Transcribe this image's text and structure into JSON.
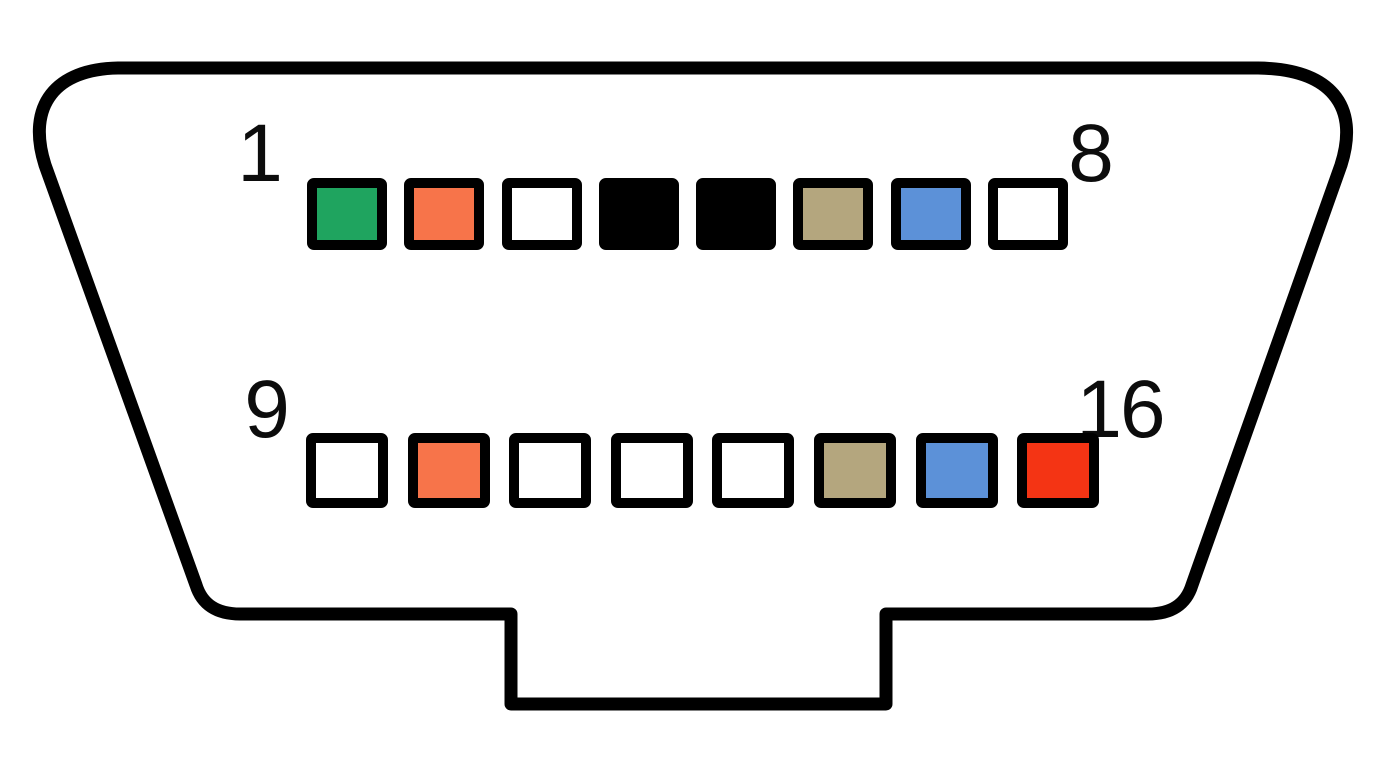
{
  "diagram": {
    "type": "connector-pinout",
    "corner_labels": {
      "top_left": "1",
      "top_right": "8",
      "bottom_left": "9",
      "bottom_right": "16"
    },
    "colors": {
      "green": "#1FA45F",
      "orange": "#F7744A",
      "white": "#FFFFFF",
      "black": "#000000",
      "tan": "#B4A67E",
      "blue": "#5C91D8",
      "red": "#F43414",
      "outline": "#000000",
      "background": "#FFFFFF",
      "artifact": "#E2F6FA"
    },
    "rows": [
      {
        "id": "top",
        "pins": [
          {
            "pin": 1,
            "color": "green"
          },
          {
            "pin": 2,
            "color": "orange"
          },
          {
            "pin": 3,
            "color": "white"
          },
          {
            "pin": 4,
            "color": "black"
          },
          {
            "pin": 5,
            "color": "black"
          },
          {
            "pin": 6,
            "color": "tan"
          },
          {
            "pin": 7,
            "color": "blue"
          },
          {
            "pin": 8,
            "color": "white"
          }
        ]
      },
      {
        "id": "bottom",
        "pins": [
          {
            "pin": 9,
            "color": "white"
          },
          {
            "pin": 10,
            "color": "orange"
          },
          {
            "pin": 11,
            "color": "white"
          },
          {
            "pin": 12,
            "color": "white"
          },
          {
            "pin": 13,
            "color": "white"
          },
          {
            "pin": 14,
            "color": "tan"
          },
          {
            "pin": 15,
            "color": "blue"
          },
          {
            "pin": 16,
            "color": "red"
          }
        ]
      }
    ]
  }
}
